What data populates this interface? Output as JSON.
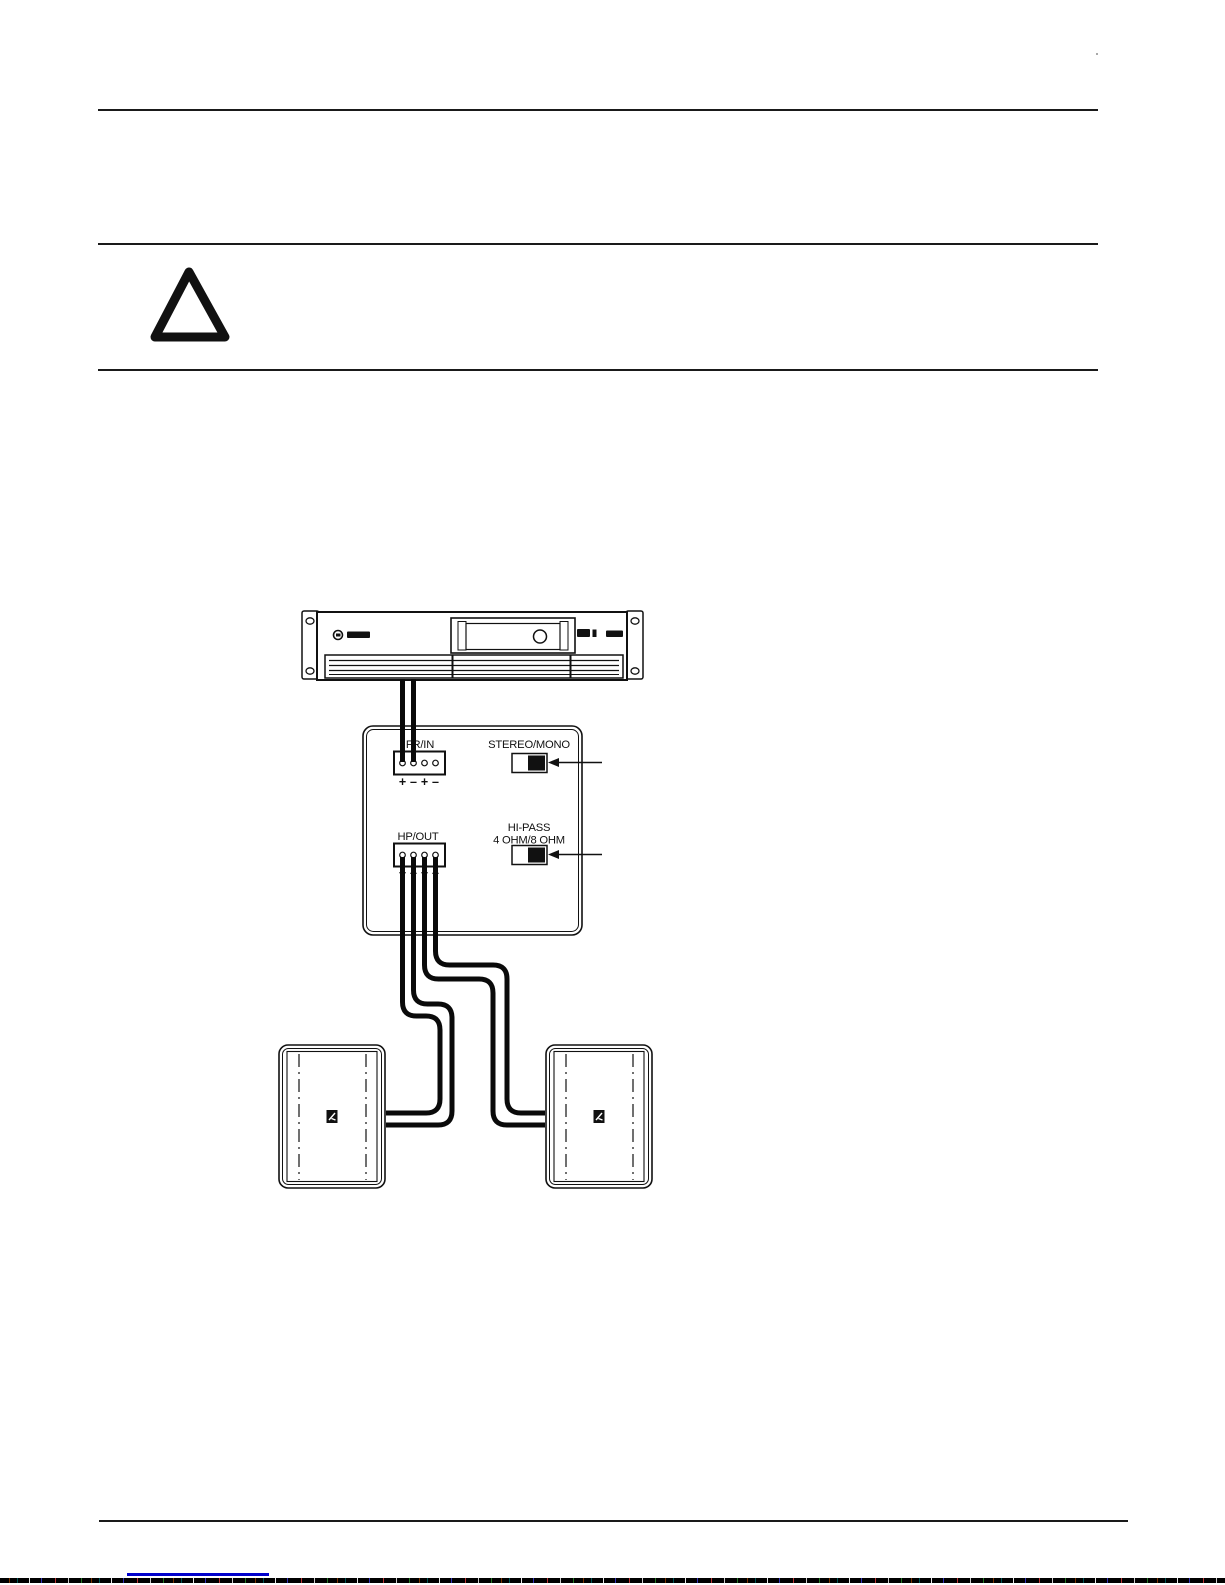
{
  "page": {
    "background": "#ffffff",
    "ink_color": "#1a1a1a",
    "link_color": "#0000cc"
  },
  "warning": {
    "icon": "warning-triangle-icon"
  },
  "diagram": {
    "amplifier": {
      "icon_names": [
        "rack-ear-left",
        "rack-ear-right",
        "brand-logo-icon",
        "display-window",
        "level-knob-icon",
        "vent-grille"
      ]
    },
    "panel": {
      "fr_in_label": "FR/IN",
      "hp_out_label": "HP/OUT",
      "stereo_mono_label": "STEREO/MONO",
      "hi_pass_label_line1": "HI-PASS",
      "hi_pass_label_line2": "4 OHM/8 OHM",
      "polarity": [
        "+",
        "–",
        "+",
        "–"
      ]
    },
    "speakers": {
      "count": 2,
      "icon": "speaker-cabinet-logo-icon"
    }
  },
  "footer": {
    "link_underline": "hyperlink-underline"
  }
}
